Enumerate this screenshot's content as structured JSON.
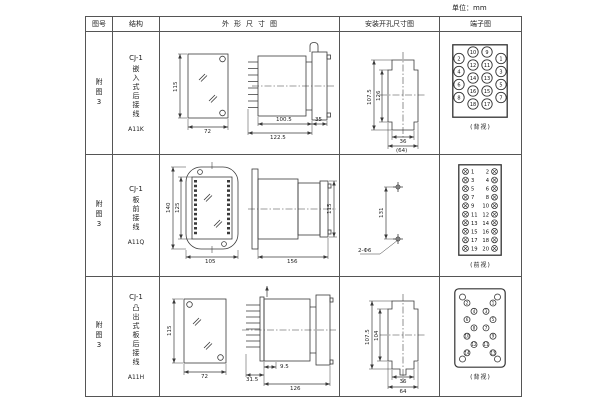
{
  "unit_label": "单位：mm",
  "header": {
    "figure": "图号",
    "structure": "结构",
    "outline": "外形尺寸图",
    "mounting": "安装开孔尺寸图",
    "terminal": "端子图"
  },
  "rows": [
    {
      "figure": "附图3",
      "model": "CJ-1",
      "desc": "嵌入式后接线",
      "code": "A11K",
      "dims": {
        "front_height": "115",
        "front_width": "72",
        "body_len": "100.5",
        "total_len": "122.5",
        "flange_w": "35",
        "cut_v_outer": "107.5",
        "cut_v_inner": "126",
        "cut_h_inner": "36",
        "cut_h_outer": "(64)"
      },
      "terminal": {
        "label": "(背视)",
        "grid_cols": [
          {
            "offset": true,
            "numbers": [
              2,
              4,
              6,
              8
            ]
          },
          {
            "offset": false,
            "numbers": [
              10,
              12,
              14,
              16,
              18
            ]
          },
          {
            "offset": false,
            "numbers": [
              9,
              11,
              13,
              15,
              17
            ]
          },
          {
            "offset": true,
            "numbers": [
              1,
              3,
              5,
              7
            ]
          }
        ]
      }
    },
    {
      "figure": "附图3",
      "model": "CJ-1",
      "desc": "板前接线",
      "code": "A11Q",
      "dims": {
        "front_h_outer": "140",
        "front_h_inner": "125",
        "front_width": "105",
        "side_len": "156",
        "side_height": "115",
        "hole_spacing": "131",
        "hole_note": "2-Φ6"
      },
      "terminal": {
        "label": "(前视)",
        "left_numbers": [
          1,
          3,
          5,
          7,
          9,
          11,
          13,
          15,
          17,
          19
        ],
        "right_numbers": [
          2,
          4,
          6,
          8,
          10,
          12,
          14,
          16,
          18,
          20
        ]
      }
    },
    {
      "figure": "附图3",
      "model": "CJ-1",
      "desc": "凸出式板后接线",
      "code": "A11H",
      "dims": {
        "front_height": "115",
        "front_width": "72",
        "pin_len": "31.5",
        "plate_gap": "9.5",
        "total_len": "126",
        "cut_v_outer": "107.5",
        "cut_v_inner": "104",
        "cut_h_inner": "36",
        "cut_h_outer": "64"
      },
      "terminal": {
        "label": "(背视)",
        "left_pins": [
          2,
          4,
          6,
          8,
          10,
          12,
          14
        ],
        "right_pins": [
          1,
          3,
          5,
          7,
          9,
          11,
          13
        ]
      }
    }
  ]
}
